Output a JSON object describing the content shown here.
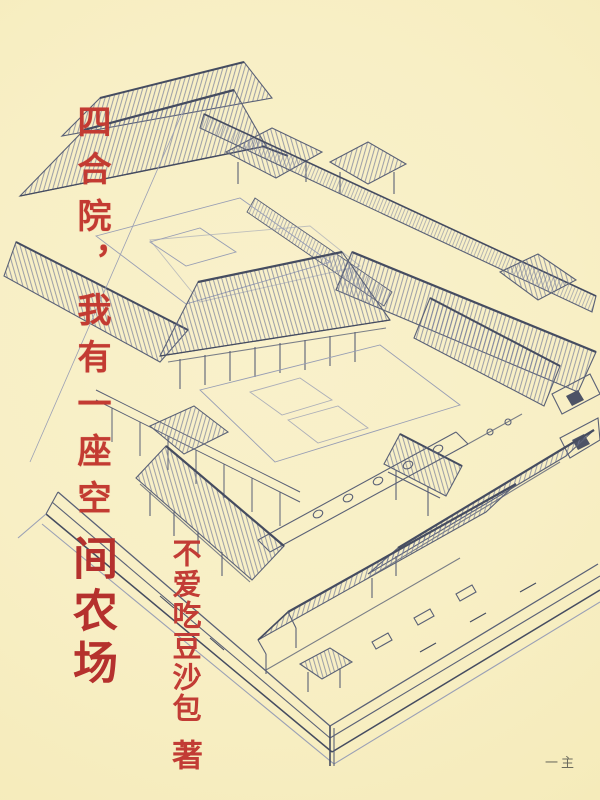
{
  "cover": {
    "background_color": "#f8efc5",
    "ink_color": "#5a6176",
    "title": {
      "script_part": "四合院，我有一座空",
      "bold_part": "间农场",
      "full_title": "四合院，我有一座空间农场",
      "script_color": "#c33b32",
      "bold_color": "#b5312d"
    },
    "author": {
      "name": "不爱吃豆沙包",
      "suffix": "著",
      "color": "#c23c35"
    },
    "corner_note": {
      "text": "一主",
      "color": "#55554e"
    },
    "illustration": {
      "name": "siheyuan-courtyard-sketch",
      "hatch_color": "#747c97",
      "accent_color": "#454c60"
    }
  }
}
